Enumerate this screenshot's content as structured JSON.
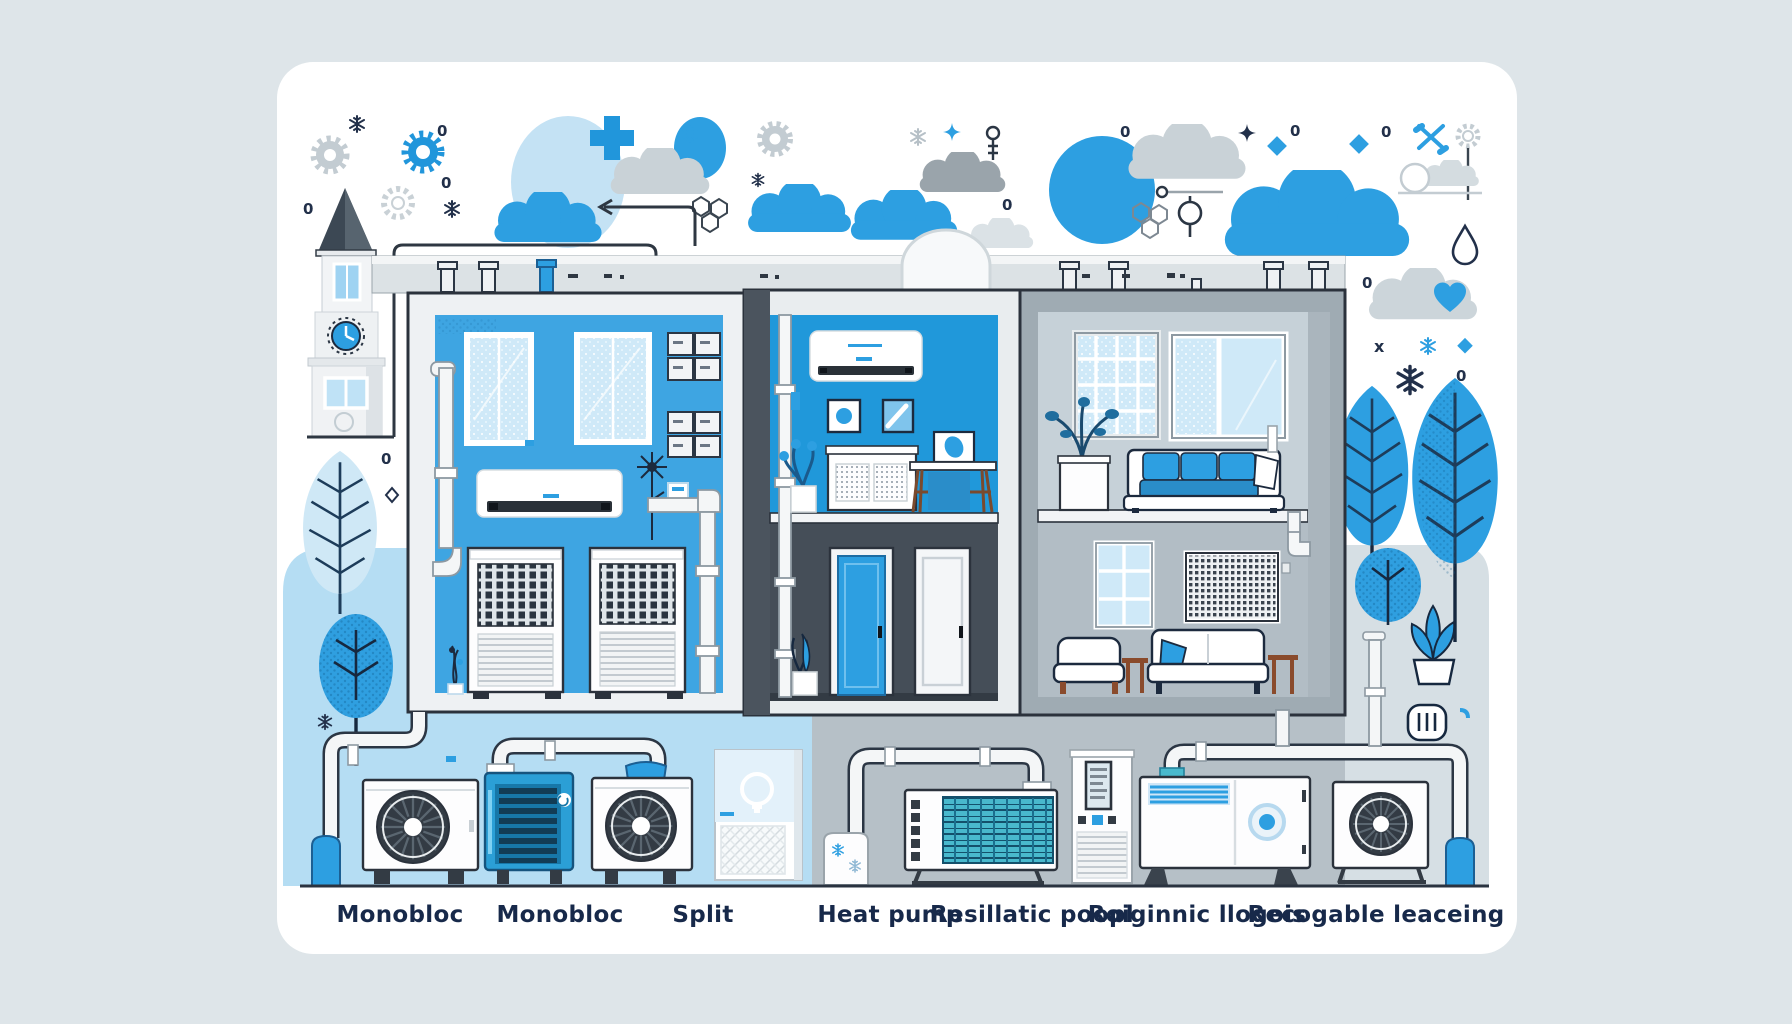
{
  "bottom_labels": {
    "items": [
      {
        "label": "Monobloc"
      },
      {
        "label": "Monobloc"
      },
      {
        "label": "Split"
      },
      {
        "label": "Heat pump"
      },
      {
        "label": "Resillatic poopl"
      },
      {
        "label": "Roiginnic llogois"
      },
      {
        "label": "Recogable leaceing"
      }
    ]
  },
  "glyphs": {
    "zero": "0",
    "x_mark": "x"
  },
  "palette": {
    "page_bg": "#dee5e9",
    "card_bg": "#ffffff",
    "primary_blue": "#2d9fe1",
    "deep_blue": "#1f93d6",
    "wall_blue_left": "#3ea5e2",
    "wall_blue_middle": "#2098da",
    "dark_room": "#454e58",
    "room_gray_top": "#c6d1d8",
    "room_gray_bottom": "#b2bdc5",
    "zone_light_blue": "#b5ddf3",
    "zone_gray": "#b6c0c7",
    "zone_pale": "#d6dfe4",
    "navy_outline": "#1c2a3e",
    "teal_coil": "#49b9cd",
    "cloud_gray": "#c9d2d7",
    "cloud_gray_dark": "#9aa4ab",
    "light_circle": "#c4e2f4"
  },
  "icons": [
    "gear-icon",
    "snowflake-icon",
    "cloud-icon",
    "sparkle-icon",
    "plus-icon",
    "diamond-icon",
    "molecule-icon",
    "arrow-icon",
    "thermometer-icon",
    "sun-arc-icon",
    "droplet-icon",
    "heart-cloud-icon",
    "clock-tower-icon",
    "tree-icon",
    "plant-pot-icon",
    "power-socket-icon",
    "lightbulb-icon",
    "fan-icon"
  ]
}
